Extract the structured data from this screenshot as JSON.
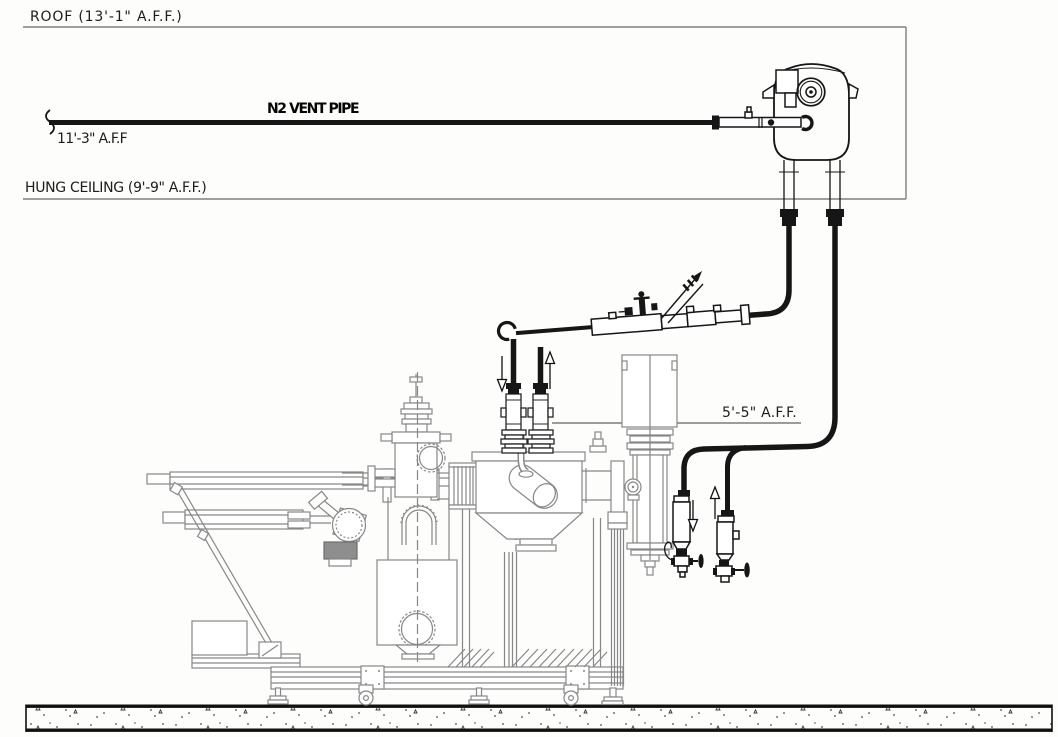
{
  "drawing": {
    "title_hint": "N2 vent piping elevation drawing",
    "labels": {
      "roof": "ROOF (13'-1\" A.F.F.)",
      "hung_ceiling": "HUNG CEILING (9'-9\" A.F.F.)",
      "n2_vent_pipe": "N2 VENT PIPE",
      "vent_pipe_elevation": "11'-3\" A.F.F",
      "equipment_elevation": "5'-5\" A.F.F."
    },
    "colors": {
      "piping": "#161616",
      "equipment_line": "#878787",
      "reference_line": "#7f7f7f",
      "text": "#1c1c1c",
      "background": "#fdfdfc"
    }
  }
}
